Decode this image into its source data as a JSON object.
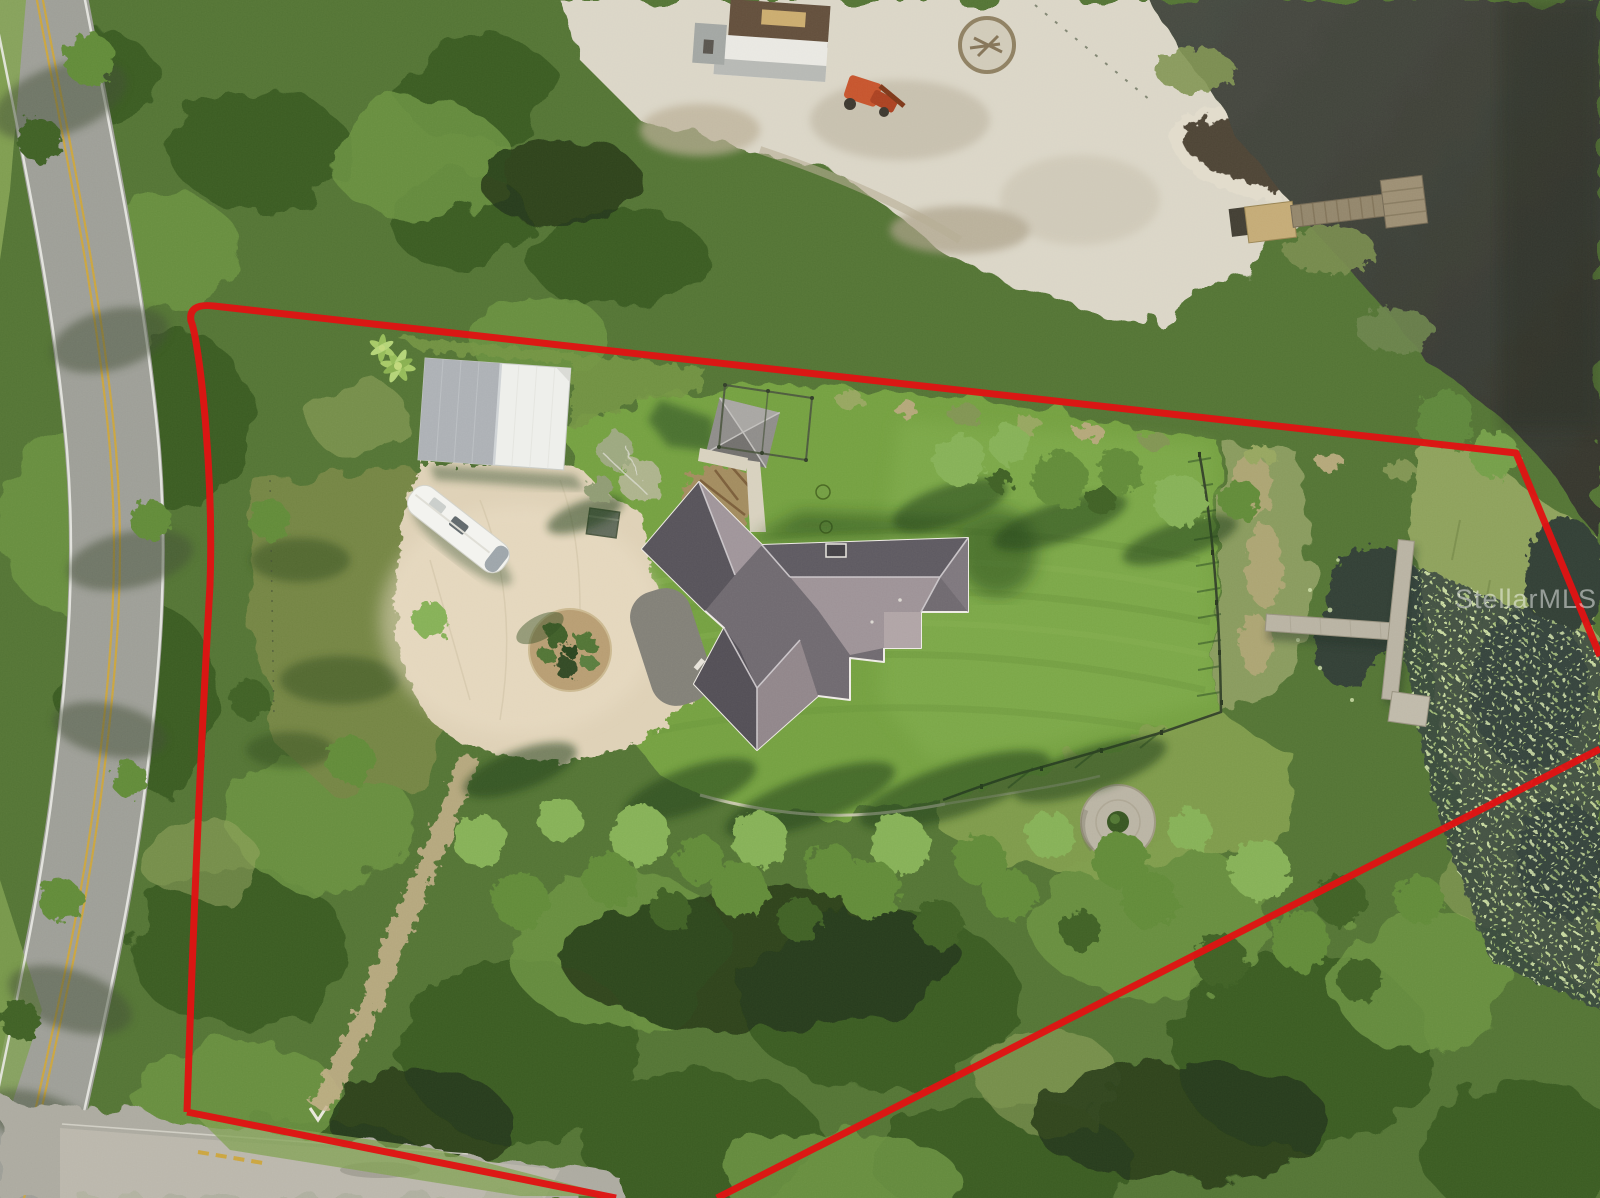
{
  "watermark": {
    "text": "StellarMLS",
    "color": "#ffffff",
    "opacity": 0.48
  },
  "annotation": {
    "type": "property-boundary-outline",
    "color": "#e01313",
    "stroke_width_px": 7
  },
  "scene": {
    "description": "Aerial drone photo of a wooded waterfront parcel outlined in red",
    "features": {
      "road": "two-lane asphalt road with double yellow centerline, left side",
      "house": "gray hip-roof house with white ridge trim, center",
      "barn": "white/gray metal outbuilding",
      "rv": "white motorhome parked on driveway",
      "pavilion": "small gray hip-roof pavilion with fenced pen",
      "driveway": "large concrete drive with landscaped circular island",
      "lawn": "large mowed green lawn with board fence on east side",
      "wooden_dock": "wooden dock on upper shoreline",
      "concrete_dock": "T-shaped dock reaching into lily pond",
      "fire_pit": "round concrete pad with center shrub",
      "water": "dark lake water with lily pads and marsh reeds",
      "clearing": "sandy neighboring clearing with sheds and equipment"
    },
    "palette": {
      "forest_green": "#4f7031",
      "lawn_green": "#6f9d3e",
      "water_dark": "#3a3d36",
      "sand": "#d9d4c5",
      "concrete": "#ddcfb4",
      "asphalt": "#9a9b94",
      "roof_dark": "#59555d",
      "roof_light": "#9a8f94",
      "boundary_red": "#e01313"
    }
  }
}
